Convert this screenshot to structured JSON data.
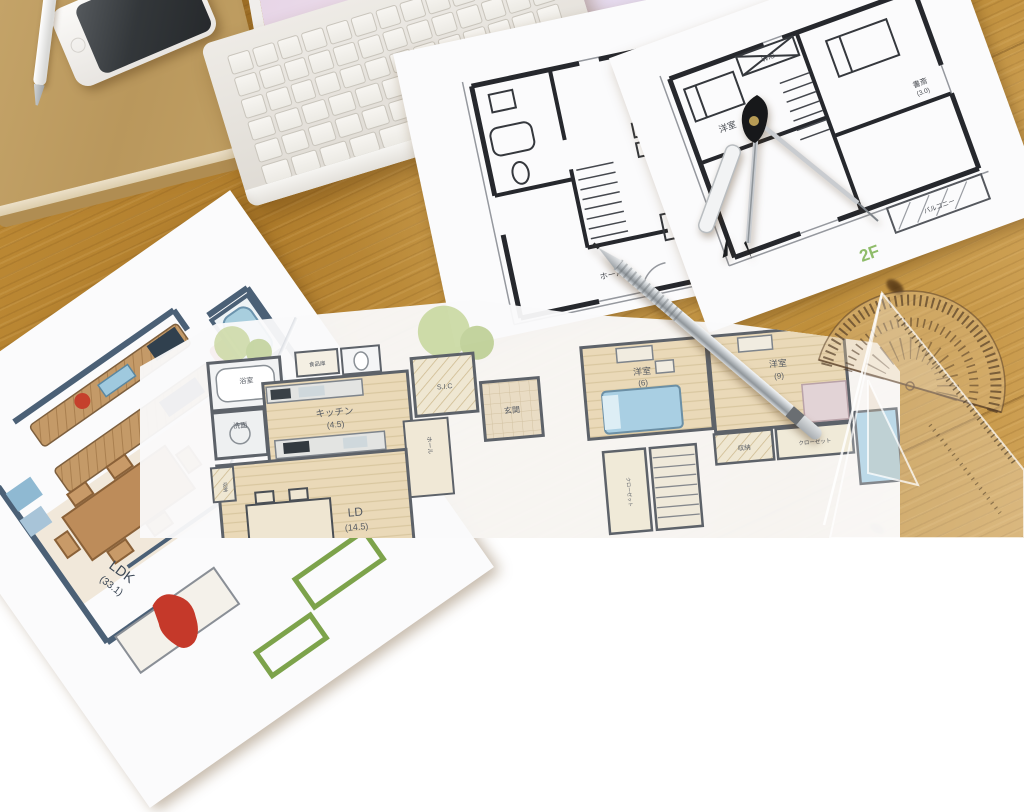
{
  "scene": {
    "setting": "hand-drawn house floor plans spread on a wooden desk with a white laptop, smartphone, kraft notebook and drafting tools",
    "colors": {
      "wood": "#b8862f",
      "wood_light": "#cfa257",
      "paper": "#fbfbfc",
      "plan_ink": "#26282d",
      "floor_label_green": "#8fbc6a",
      "watercolor_floor": "#ead9b8",
      "bed_blue": "#a9cfe3",
      "sofa_red": "#c5392a",
      "furniture_brown": "#bd8c5a",
      "wall_blue_gray": "#4b6076",
      "tree_green": "#c6d69c"
    }
  },
  "objects": {
    "desk": "wooden-desk",
    "laptop": "white-laptop",
    "phone": "smartphone",
    "notebook": "kraft-notebook",
    "white_pen": "white-ballpoint-pen",
    "pencil": "silver-mechanical-pencil",
    "compass": "drafting-compass",
    "protractor": "semicircular-protractor",
    "triangle": "transparent-set-square",
    "tracing_sheet": "tracing-paper-sheet"
  },
  "plans": {
    "bw1f": {
      "name": "monochrome first floor plan",
      "labels": {
        "ldk": "LDK",
        "size": "(16.0)",
        "hall": "ホール"
      }
    },
    "bw2f": {
      "name": "monochrome second floor plan",
      "floor": "2F",
      "labels": {
        "room": "洋室",
        "wic": "WIC",
        "study": "書斎",
        "study_size": "(3.0)",
        "balcony": "バルコニー"
      }
    },
    "colored": {
      "name": "colored LDK plan",
      "labels": {
        "ldk": "LDK",
        "size": "(33.1)"
      }
    },
    "watercolor": {
      "name": "watercolor plan with 1F and 2F",
      "labels": {
        "bath": "浴室",
        "wash": "洗面",
        "pantry": "食品庫",
        "kitchen": "キッチン",
        "kitchen_size": "(4.5)",
        "sic": "S.I.C",
        "genkan": "玄関",
        "hall": "ホール",
        "ld": "LD",
        "ld_size": "(14.5)",
        "storage": "収納",
        "room6": "洋室",
        "room6_size": "(6)",
        "room9": "洋室",
        "room9_size": "(9)",
        "storage2": "収納",
        "closet": "クローゼット",
        "closet2": "クローゼット"
      }
    }
  }
}
